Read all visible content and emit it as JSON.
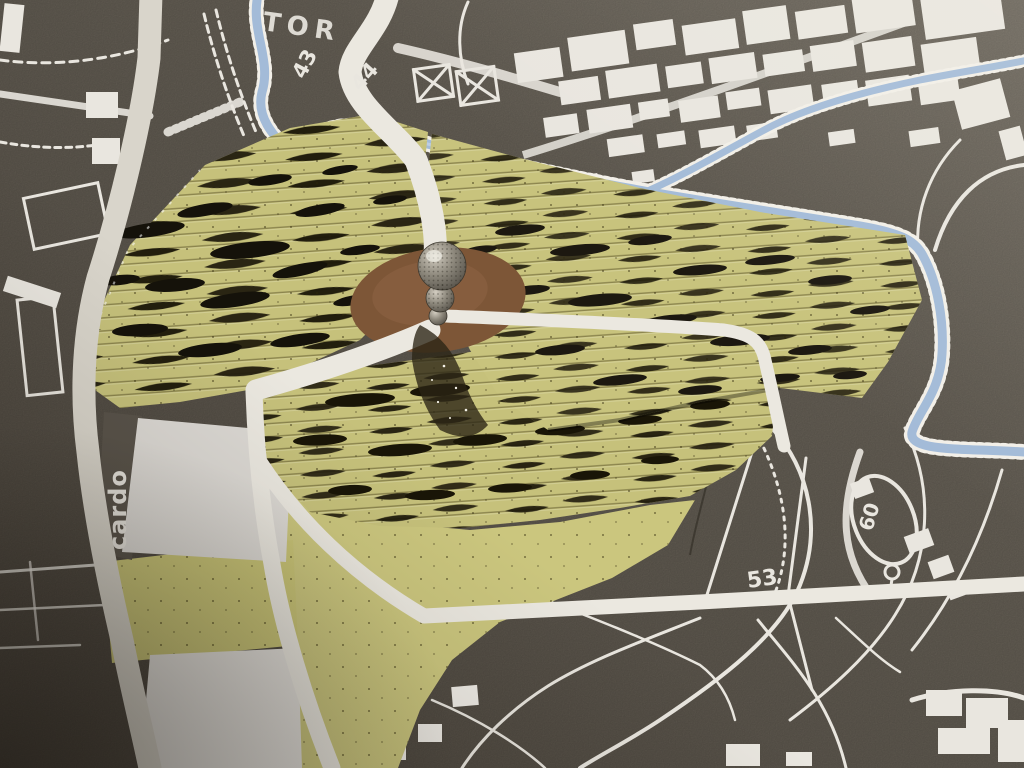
{
  "scene": {
    "medium": "photograph",
    "subject": "physical urban planning site model: rippled paper terrain over a printed base map with river, roads and a central sculpted marker"
  },
  "labels": {
    "town": "TOR",
    "parcel_43": "43",
    "parcel_44": "44",
    "street_cardo": "cardo",
    "parcel_53": "53",
    "parcel_60": "60"
  },
  "palette": {
    "base_dark": "#575047",
    "base_light": "#756f65",
    "terrain_green": "#c6c17b",
    "terrain_strip_shadow": "#1c170b",
    "river_blue": "#a3bbd8",
    "river_highlight": "#c3d2e6",
    "road_white": "#ebe8e0",
    "road_gray": "#d9d5cb",
    "print_white": "#e9e6df",
    "plaza_brown": "#7d5637",
    "metal_light": "#cfc9bd",
    "metal_dark": "#4e4a42"
  }
}
